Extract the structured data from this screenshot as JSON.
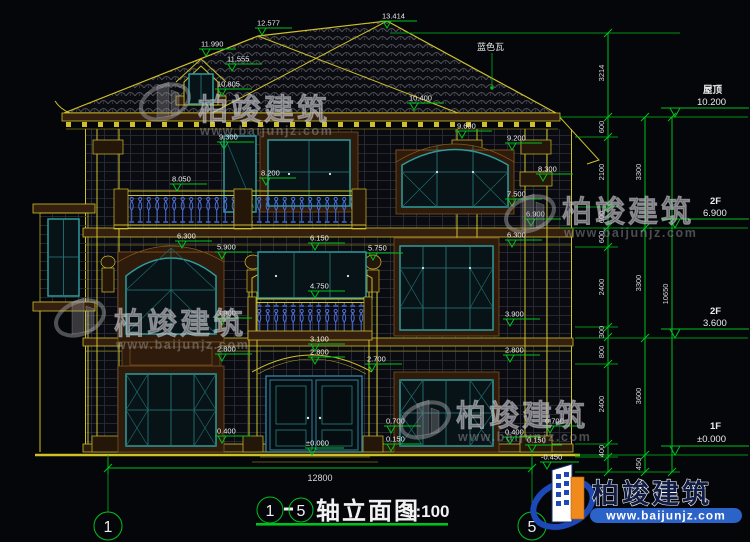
{
  "title_block": {
    "axis_start": "1",
    "separator": "－",
    "axis_end": "5",
    "name": "轴立面图",
    "scale": "1:100"
  },
  "axes": {
    "left": "1",
    "right": "5"
  },
  "notes": {
    "roof_tile": "蓝色瓦"
  },
  "levels": [
    {
      "name": "屋顶",
      "elev": "10.200"
    },
    {
      "name": "2F",
      "elev": "6.900"
    },
    {
      "name": "2F",
      "elev": "3.600"
    },
    {
      "name": "1F",
      "elev": "±0.000"
    }
  ],
  "marks": [
    "13.414",
    "12.577",
    "11.990",
    "11.555",
    "10.805",
    "10.400",
    "9.600",
    "9.300",
    "9.200",
    "8.300",
    "8.200",
    "8.050",
    "7.500",
    "6.900",
    "6.300",
    "6.300",
    "6.150",
    "5.900",
    "5.750",
    "4.750",
    "3.900",
    "3.900",
    "3.100",
    "2.800",
    "2.800",
    "2.700",
    "2.800",
    "0.400",
    "0.700",
    "0.150",
    "±0.000",
    "0.700",
    "0.400",
    "0.150",
    "-0.450"
  ],
  "dims": {
    "offset_peak": "3214",
    "fine": [
      "600",
      "2100",
      "600",
      "600",
      "2400",
      "300",
      "800",
      "2400",
      "400"
    ],
    "floors": [
      "3300",
      "3300",
      "3600",
      "450"
    ],
    "total": "10650",
    "width": "12800"
  },
  "watermark": {
    "name": "柏竣建筑",
    "url": "www.baijunjz.com"
  },
  "logo": {
    "name": "柏竣建筑",
    "url": "www.baijunjz.com"
  },
  "colors": {
    "background": "#05060a",
    "cad_yellow": "#cfc02a",
    "cad_green": "#00c21c",
    "window_teal": "#2f9b9b",
    "baluster_blue": "#4a6ede",
    "brand_blue": "#1d49b8",
    "brand_orange": "#f08a1d"
  }
}
